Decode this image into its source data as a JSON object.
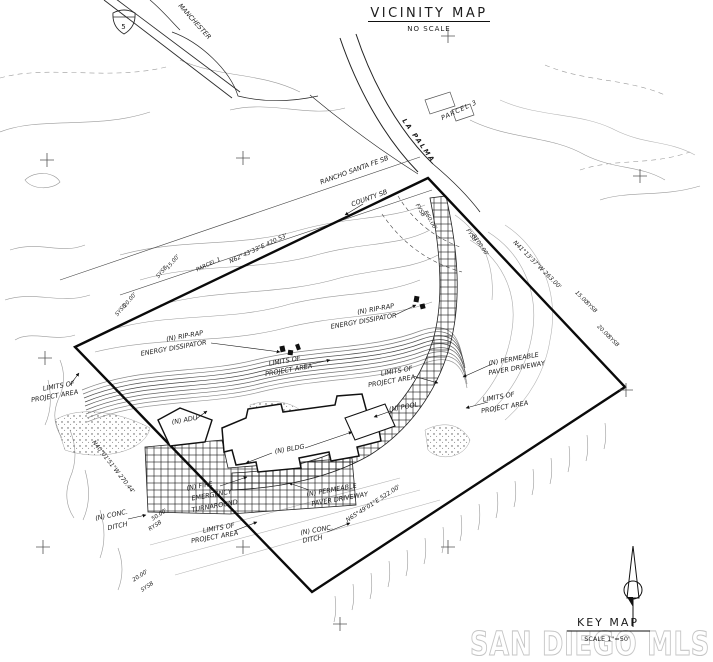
{
  "title": {
    "main": "VICINITY MAP",
    "sub": "NO SCALE"
  },
  "vicinity": {
    "shield": "5",
    "road": "MANCHESTER"
  },
  "streets": {
    "rancho": "RANCHO SANTA FE SB",
    "county": "COUNTY SB",
    "la_palma": "LA PALMA",
    "parcel_3": "PARCEL 3",
    "parcel_1": "PARCEL 1"
  },
  "bearings": {
    "top": "N62°43'33\"E  420.53'",
    "left": "N40°01'51\"W  270.44'",
    "right": "N41°13'37\"W  263.00'",
    "bottom": "N65°49'01\"E  522.00'"
  },
  "setbacks": {
    "d15": "15.00'",
    "d20": "20.00'",
    "d50": "50.00'",
    "sysb": "SYSB",
    "rysb": "RYSB",
    "fysb": "FYSB",
    "r60": "R60.00'",
    "r100": "R100.00'"
  },
  "labels": {
    "rip_l1": "(N) RIP-RAP",
    "rip_l2": "ENERGY DISSIPATOR",
    "limits_l1": "LIMITS OF",
    "limits_l2": "PROJECT AREA",
    "perm_l1": "(N) PERMEABLE",
    "perm_l2": "PAVER DRIVEWAY",
    "pool": "(N) POOL",
    "adu": "(N) ADU",
    "bldg": "(N) BLDG",
    "fire_l1": "(N) FIRE",
    "fire_l2": "EMERGENCY",
    "fire_l3": "TURNAROUND",
    "conc_l1": "(N) CONC.",
    "conc_l2": "DITCH"
  },
  "keymap": {
    "title": "KEY MAP",
    "scale": "SCALE 1\"=50'"
  },
  "watermark": "SAN DIEGO MLS"
}
